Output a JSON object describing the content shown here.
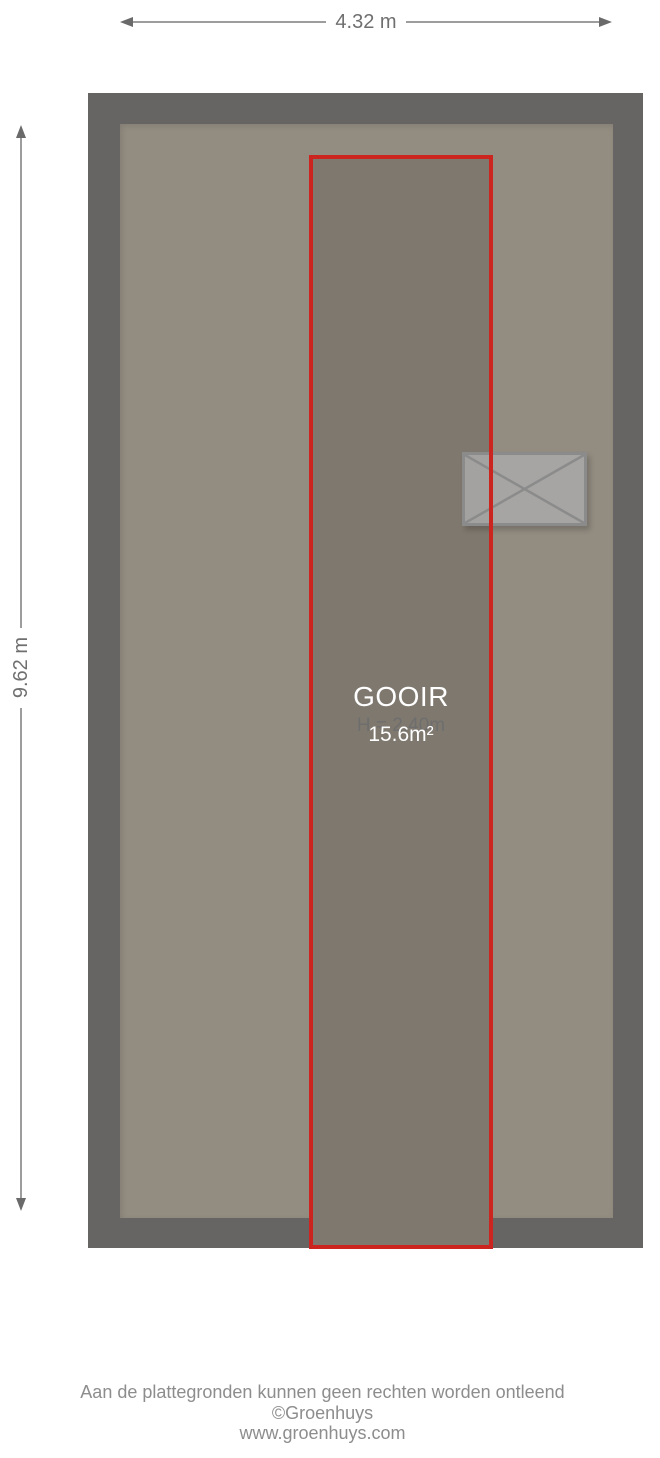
{
  "dimensions": {
    "width_label": "4.32 m",
    "height_label": "9.62 m"
  },
  "room": {
    "name": "GOOIR",
    "ceiling_height_label": "H = 2.40m",
    "area_label": "15.6m²"
  },
  "footer": {
    "disclaimer": "Aan de plattegronden kunnen geen rechten worden ontleend",
    "copyright": "©Groenhuys",
    "website": "www.groenhuys.com"
  },
  "colors": {
    "wall": "#666564",
    "floor": "#928c81",
    "room": "#7f786e",
    "accent": "#cc241e",
    "window-stroke": "#8b8b8b",
    "dim-text": "#6f6f6f",
    "muted-text": "#8d8d8d"
  }
}
